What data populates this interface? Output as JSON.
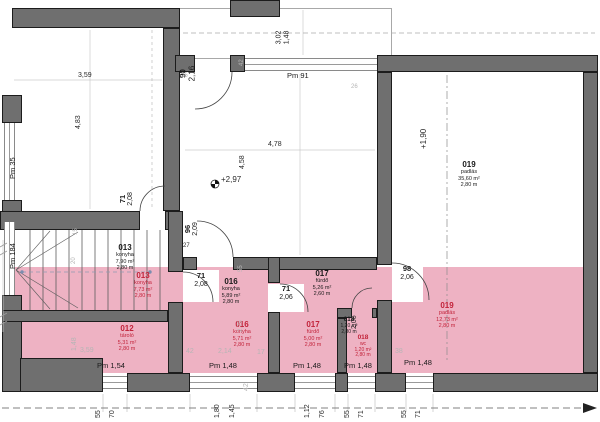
{
  "drawing": {
    "type": "architectural floor plan",
    "language": "Hungarian"
  },
  "colors": {
    "wall": "#6f6f6f",
    "highlight_pink": "#eeb2c3",
    "red_text": "#c2233a"
  },
  "rooms": {
    "r012_red": {
      "num": "012",
      "name": "tároló",
      "area": "5,31 m²",
      "height": "2,80 m"
    },
    "r013_black": {
      "num": "013",
      "name": "konyha",
      "area": "7,90 m²",
      "height": "2,80 m"
    },
    "r013_red": {
      "num": "013",
      "name": "konyha",
      "area": "7,73 m²",
      "height": "2,80 m"
    },
    "r016_black": {
      "num": "016",
      "name": "konyha",
      "area": "5,89 m²",
      "height": "2,80 m"
    },
    "r016_red": {
      "num": "016",
      "name": "konyha",
      "area": "5,71 m²",
      "height": "2,80 m"
    },
    "r017_black": {
      "num": "017",
      "name": "fürdő",
      "area": "5,26 m²",
      "height": "2,60 m"
    },
    "r017_red": {
      "num": "017",
      "name": "fürdő",
      "area": "5,00 m²",
      "height": "2,80 m"
    },
    "r018_black": {
      "num": "018",
      "name": "",
      "area": "1,20 m²",
      "height": "2,80 m"
    },
    "r018_red": {
      "num": "018",
      "name": "wc",
      "area": "1,20 m²",
      "height": "2,80 m"
    },
    "r019_black": {
      "num": "019",
      "name": "padlás",
      "area": "35,60 m²",
      "height": "2,80 m"
    },
    "r019_red": {
      "num": "019",
      "name": "padlás",
      "area": "12,73 m²",
      "height": "2,80 m"
    }
  },
  "doors": {
    "d1": {
      "w": "71",
      "h": "2,08"
    },
    "d2": {
      "w": "90",
      "h": "2,16"
    },
    "d3": {
      "w": "96",
      "h": "2,09"
    },
    "d4": {
      "w": "71",
      "h": "2,08"
    },
    "d5": {
      "w": "71",
      "h": "2,06"
    },
    "d6": {
      "h": "2,06"
    },
    "d7": {
      "w": "98",
      "h": "2,06"
    }
  },
  "windows": {
    "pm35": "Pm 35",
    "pm184": "Pm 184",
    "pm91": "Pm 91",
    "pm154": "Pm 1,54",
    "pm148a": "Pm 1,48",
    "pm148b": "Pm 1,48",
    "pm148c": "Pm 1,48",
    "pm148d": "Pm 1,48"
  },
  "levels": {
    "mid": "+2,97",
    "attic": "+1,90"
  },
  "dims": {
    "tl_w": "3,59",
    "tl_h": "4,83",
    "mid_w": "4,78",
    "mid_h": "4,58",
    "terr_a": "3,02",
    "terr_b": "1,48",
    "d25": "25",
    "d26": "26",
    "d27": "27",
    "d42": "42",
    "d15": "15",
    "d20": "20",
    "d55": "55",
    "d275": "2,75",
    "g359": "3,59",
    "g148": "1,48",
    "g42": "42",
    "g42b": "42",
    "g214": "2,14",
    "g17": "17",
    "g38": "38"
  },
  "bottom_chain": [
    "55",
    "70",
    "1,80",
    "1,45",
    "1,12",
    "76",
    "55",
    "71",
    "55",
    "71"
  ]
}
